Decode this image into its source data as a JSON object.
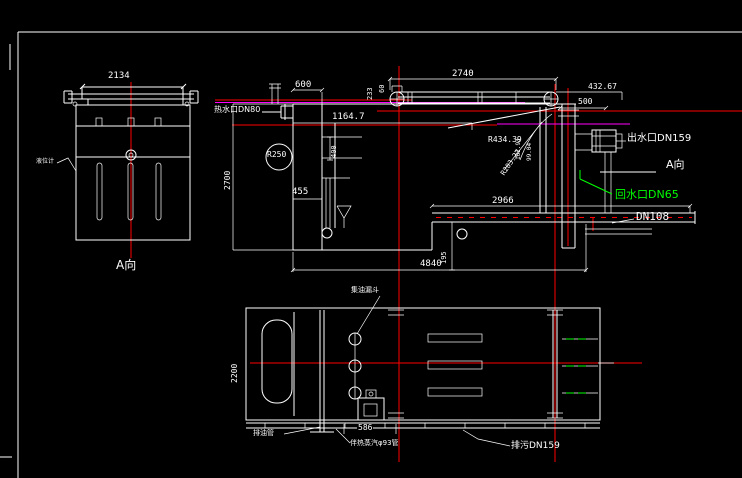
{
  "colors": {
    "bg": "#000000",
    "line": "#ffffff",
    "centerline": "#ff0000",
    "magenta": "#ff00ff",
    "green": "#00ff00"
  },
  "left_view": {
    "dim_width": "2134",
    "level_gauge_label": "液位计",
    "view_label": "A向"
  },
  "elevation": {
    "dim_600": "600",
    "dim_2740": "2740",
    "dim_432_67": "432.67",
    "dim_500": "500",
    "dim_1164_7": "1164.7",
    "dim_2700": "2700",
    "dim_400": "400",
    "dim_455": "455",
    "dim_233": "233",
    "dim_60": "60",
    "radius_r250": "R250",
    "radius_r434": "R434.39",
    "radius_r203": "R203.27",
    "dim_102_93": "102.93",
    "dim_99_04": "99.04",
    "dim_2966": "2966",
    "dim_4840": "4840",
    "dim_195": "195",
    "hot_water_label": "热水口DN80",
    "outlet_label": "出水口DN159",
    "view_label": "A向",
    "return_water_label": "回水口DN65",
    "dn108_label": "DN108"
  },
  "plan_view": {
    "dim_2200": "2200",
    "dim_586": "586",
    "funnel_label": "集油漏斗",
    "oil_pipe_label": "排油管",
    "steam_label": "伴热蒸汽φ93管",
    "drain_label": "排污DN159"
  }
}
